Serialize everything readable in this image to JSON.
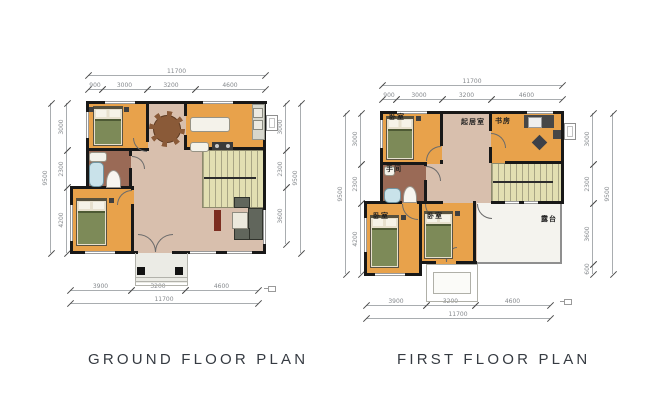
{
  "titles": {
    "ground": "GROUND FLOOR PLAN",
    "first": "FIRST FLOOR PLAN"
  },
  "ground": {
    "dims": {
      "top_total": "11700",
      "top_segments": [
        "900",
        "3000",
        "3200",
        "4600"
      ],
      "left_total": "9500",
      "left_segments": [
        "3000",
        "2300",
        "4200"
      ],
      "right_segments": [
        "3000",
        "2300",
        "3600"
      ],
      "right_total": "9500",
      "bottom_segments": [
        "3900",
        "3200",
        "4600"
      ],
      "bottom_total": "11700"
    }
  },
  "first": {
    "dims": {
      "top_total": "11700",
      "top_segments": [
        "900",
        "3000",
        "3200",
        "4600"
      ],
      "left_total": "9500",
      "left_segments": [
        "3000",
        "2300",
        "4200"
      ],
      "right_segments": [
        "3000",
        "2300",
        "3600",
        "600"
      ],
      "right_total": "9500",
      "bottom_segments": [
        "3900",
        "3200",
        "4600"
      ],
      "bottom_total": "11700"
    },
    "rooms": {
      "bedroom_top": "卧室",
      "living": "起居室",
      "study": "书房",
      "bath": "手间",
      "bedroom_left": "卧室",
      "bedroom_mid": "卧室",
      "terrace": "露台"
    }
  },
  "colors": {
    "wall": "#181818",
    "bedroom_floor": "#e8a24b",
    "hall_floor": "#d8bfad",
    "bath_floor": "#9a6a56",
    "stairs_floor": "#e2dfb2",
    "terrace_floor": "#f4f3ee"
  }
}
